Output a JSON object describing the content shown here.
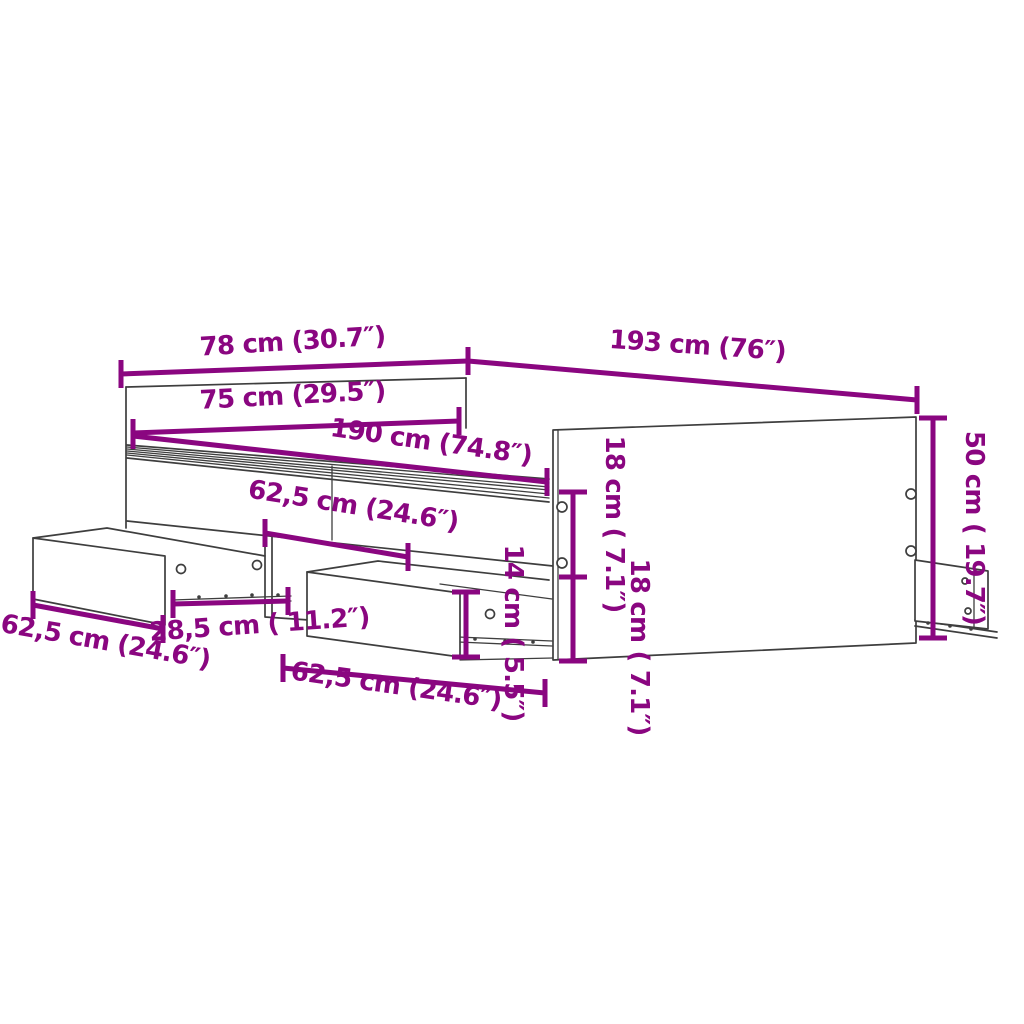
{
  "diagram": {
    "colors": {
      "accent": "#8A0680",
      "line_art": "#3E3E3E",
      "background": "#FFFFFF"
    },
    "labels": {
      "headboard_outer_width": "78 cm (30.7″)",
      "frame_outer_length": "193 cm (76″)",
      "inner_width": "75 cm (29.5″)",
      "inner_length": "190 cm (74.8″)",
      "upper_drawer_width": "62,5 cm (24.6″)",
      "left_drawer_width": "62,5 cm (24.6″)",
      "drawer_side_depth": "28,5 cm ( 11.2″)",
      "lower_drawer_width": "62,5 cm (24.6″)",
      "drawer_front_height": "14 cm ( 5.5″)",
      "side_rail_height": "18 cm ( 7.1″)",
      "under_bed_height": "18 cm ( 7.1″)",
      "footboard_height": "50 cm ( 19.7″)"
    }
  }
}
